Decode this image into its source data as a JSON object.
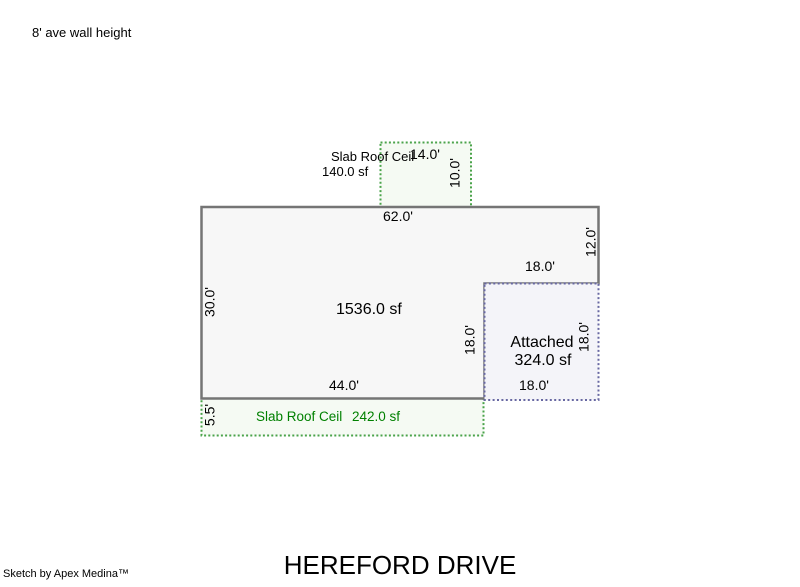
{
  "colors": {
    "outline": "#757575",
    "main_fill": "#f7f7f7",
    "attached_border": "#6868a2",
    "attached_fill": "#f4f4f9",
    "slab_border": "#4aa34a",
    "slab_fill": "#f5faf3",
    "slab_text": "#008000",
    "text": "#000000"
  },
  "header": {
    "wall_height_note": "8' ave wall height"
  },
  "top_slab": {
    "label": "Slab Roof Ceil",
    "area": "140.0 sf",
    "dim_width": "14.0'",
    "dim_depth": "10.0'"
  },
  "main_area": {
    "area": "1536.0 sf",
    "dim_top": "62.0'",
    "dim_left": "30.0'",
    "dim_right": "12.0'",
    "dim_bottom": "44.0'",
    "dim_notch_top": "18.0'",
    "dim_notch_side": "18.0'"
  },
  "attached_area": {
    "name": "Attached",
    "area": "324.0 sf",
    "dim_right": "18.0'",
    "dim_bottom": "18.0'"
  },
  "bottom_slab": {
    "label": "Slab Roof Ceil",
    "area": "242.0 sf",
    "dim_left": "5.5'"
  },
  "footer": {
    "street_title": "HEREFORD DRIVE",
    "credit": "Sketch by Apex Medina™"
  }
}
